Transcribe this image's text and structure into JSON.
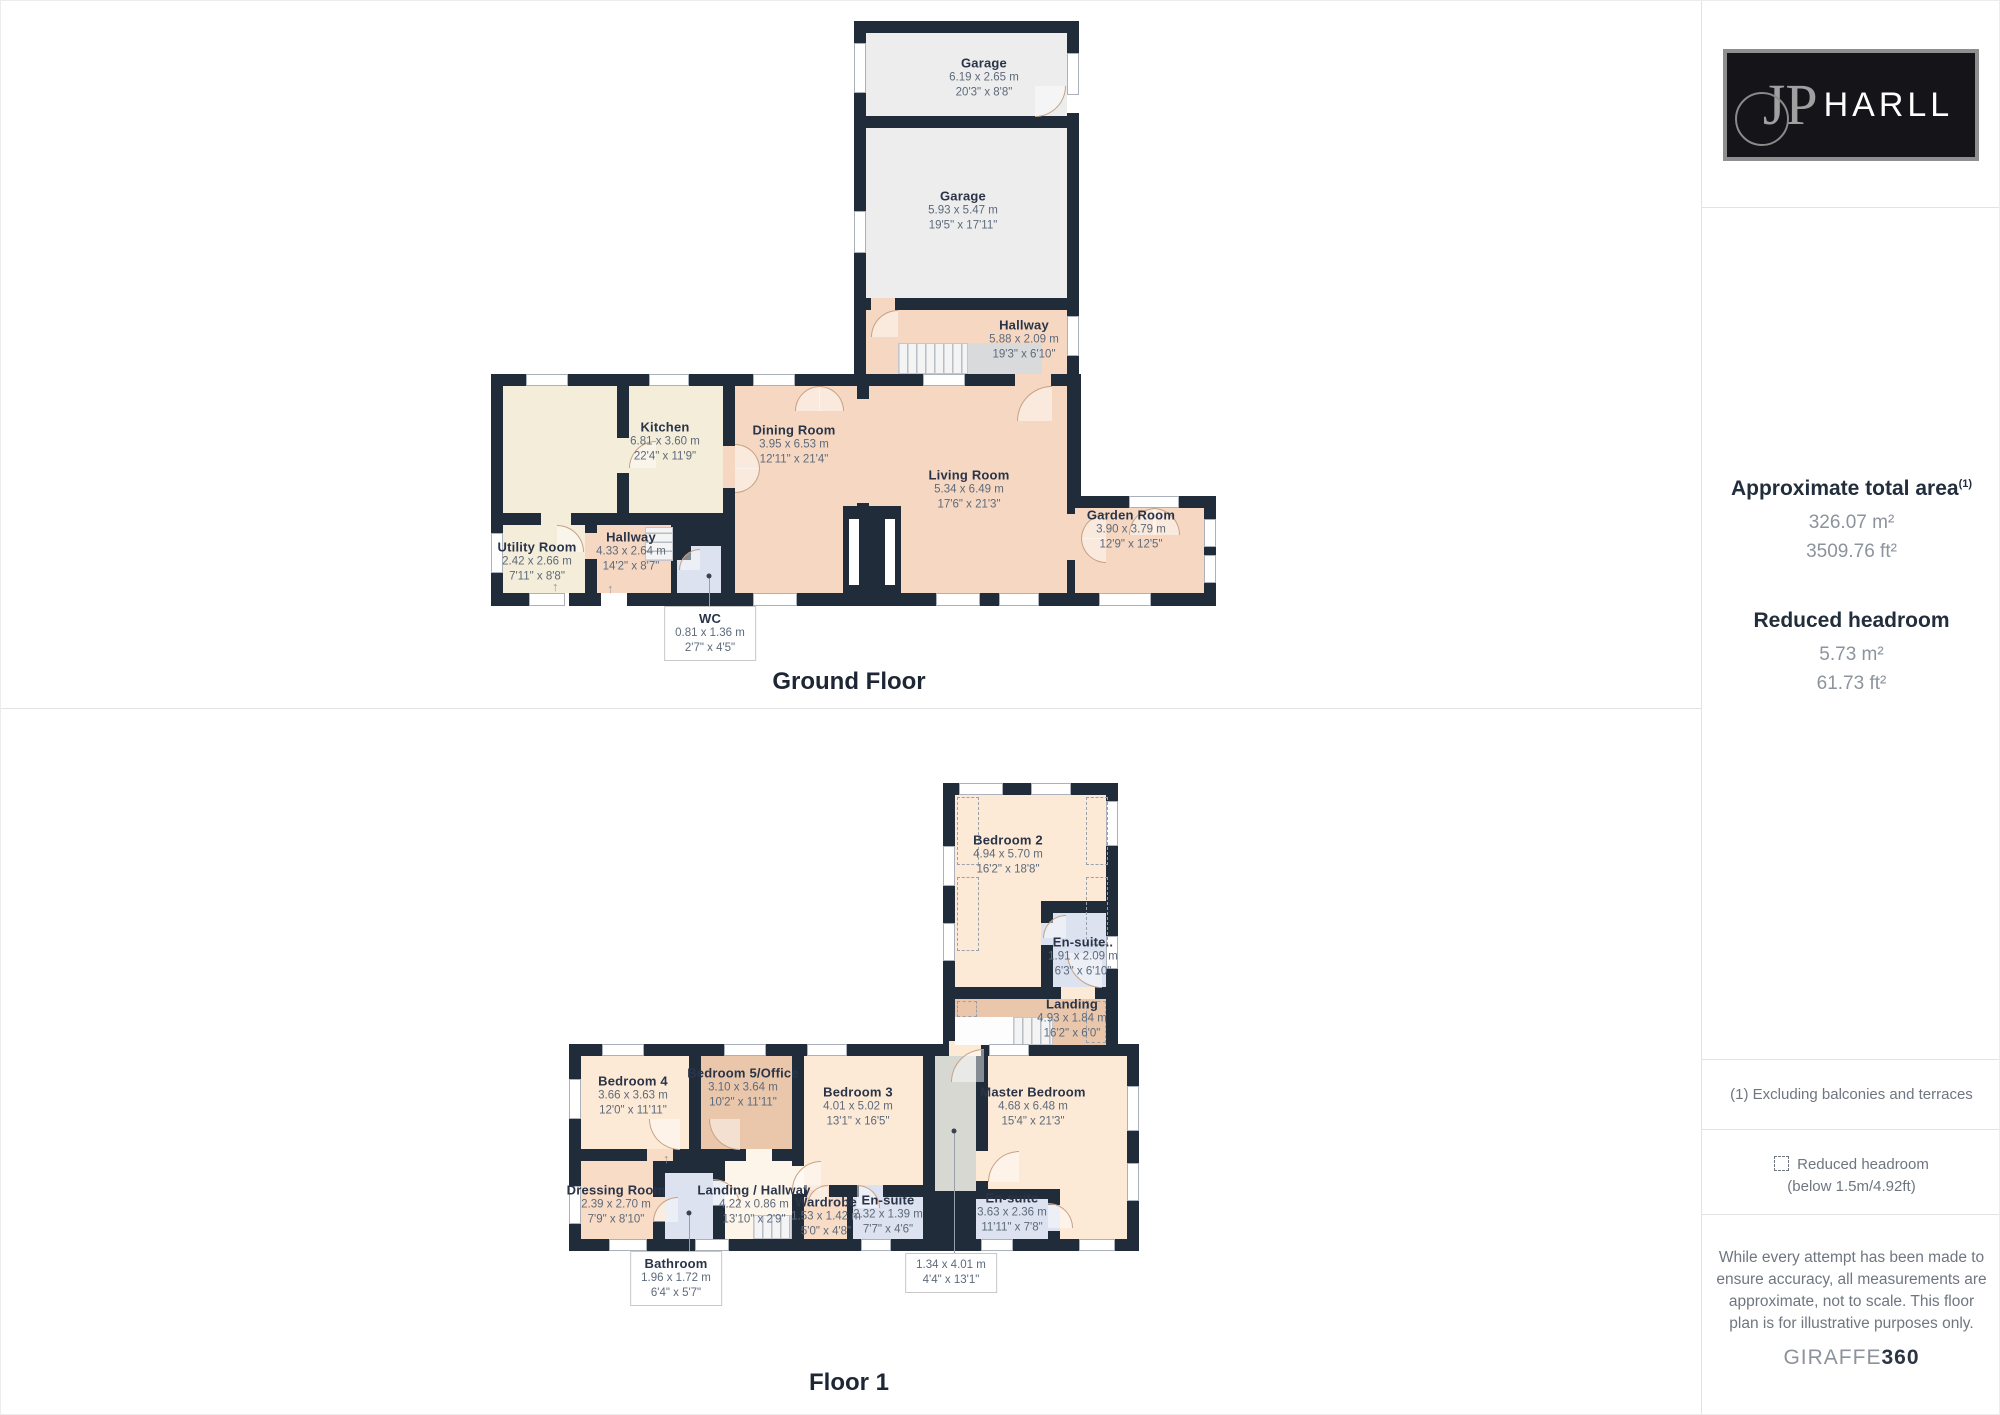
{
  "ground_floor": {
    "title": "Ground Floor",
    "rooms": [
      {
        "name": "Garage",
        "metric": "6.19 x 2.65 m",
        "imperial": "20'3\" x 8'8\""
      },
      {
        "name": "Garage",
        "metric": "5.93 x 5.47 m",
        "imperial": "19'5\" x 17'11\""
      },
      {
        "name": "Hallway",
        "metric": "5.88 x 2.09 m",
        "imperial": "19'3\" x 6'10\""
      },
      {
        "name": "Kitchen",
        "metric": "6.81 x 3.60 m",
        "imperial": "22'4\" x 11'9\""
      },
      {
        "name": "Dining Room",
        "metric": "3.95 x 6.53 m",
        "imperial": "12'11\" x 21'4\""
      },
      {
        "name": "Living Room",
        "metric": "5.34 x 6.49 m",
        "imperial": "17'6\" x 21'3\""
      },
      {
        "name": "Garden Room",
        "metric": "3.90 x 3.79 m",
        "imperial": "12'9\" x 12'5\""
      },
      {
        "name": "Utility Room",
        "metric": "2.42 x 2.66 m",
        "imperial": "7'11\" x 8'8\""
      },
      {
        "name": "Hallway",
        "metric": "4.33 x 2.64 m",
        "imperial": "14'2\" x 8'7\""
      },
      {
        "name": "WC",
        "metric": "0.81 x 1.36 m",
        "imperial": "2'7\" x 4'5\""
      }
    ]
  },
  "floor1": {
    "title": "Floor 1",
    "rooms": [
      {
        "name": "Bedroom 2",
        "metric": "4.94 x 5.70 m",
        "imperial": "16'2\" x 18'8\""
      },
      {
        "name": "En-suite..",
        "metric": "1.91 x 2.09 m",
        "imperial": "6'3\" x 6'10\""
      },
      {
        "name": "Landing",
        "metric": "4.93 x 1.84 m",
        "imperial": "16'2\" x 6'0\""
      },
      {
        "name": "Bedroom 4",
        "metric": "3.66 x 3.63 m",
        "imperial": "12'0\" x 11'11\""
      },
      {
        "name": "Bedroom 5/Office",
        "metric": "3.10 x 3.64 m",
        "imperial": "10'2\" x 11'11\""
      },
      {
        "name": "Bedroom 3",
        "metric": "4.01 x 5.02 m",
        "imperial": "13'1\" x 16'5\""
      },
      {
        "name": "Master Bedroom",
        "metric": "4.68 x 6.48 m",
        "imperial": "15'4\" x 21'3\""
      },
      {
        "name": "Dressing Room",
        "metric": "2.39 x 2.70 m",
        "imperial": "7'9\" x 8'10\""
      },
      {
        "name": "Landing / Hallway",
        "metric": "4.22 x 0.86 m",
        "imperial": "13'10\" x 2'9\""
      },
      {
        "name": "Wardrobe",
        "metric": "1.53 x 1.42 m",
        "imperial": "5'0\" x 4'8\""
      },
      {
        "name": "En-suite",
        "metric": "2.32 x 1.39 m",
        "imperial": "7'7\" x 4'6\""
      },
      {
        "name": "En-suite",
        "metric": "3.63 x 2.36 m",
        "imperial": "11'11\" x 7'8\""
      },
      {
        "name": "Bathroom",
        "metric": "1.96 x 1.72 m",
        "imperial": "6'4\" x 5'7\""
      },
      {
        "name": "",
        "metric": "1.34 x 4.01 m",
        "imperial": "4'4\" x 13'1\""
      }
    ]
  },
  "sidebar": {
    "logo": {
      "jp": "JP",
      "harll": "HARLL"
    },
    "total_area": {
      "title": "Approximate total area",
      "sup": "(1)",
      "m2": "326.07 m²",
      "ft2": "3509.76 ft²"
    },
    "reduced_headroom": {
      "title": "Reduced headroom",
      "m2": "5.73 m²",
      "ft2": "61.73 ft²"
    },
    "footnote": "(1) Excluding balconies and terraces",
    "legend": {
      "line1": "Reduced headroom",
      "line2": "(below 1.5m/4.92ft)"
    },
    "disclaimer": "While every attempt has been made to ensure accuracy, all measurements are approximate, not to scale. This floor plan is for illustrative purposes only.",
    "brand": {
      "giraffe": "GIRAFFE",
      "num": "360"
    }
  }
}
